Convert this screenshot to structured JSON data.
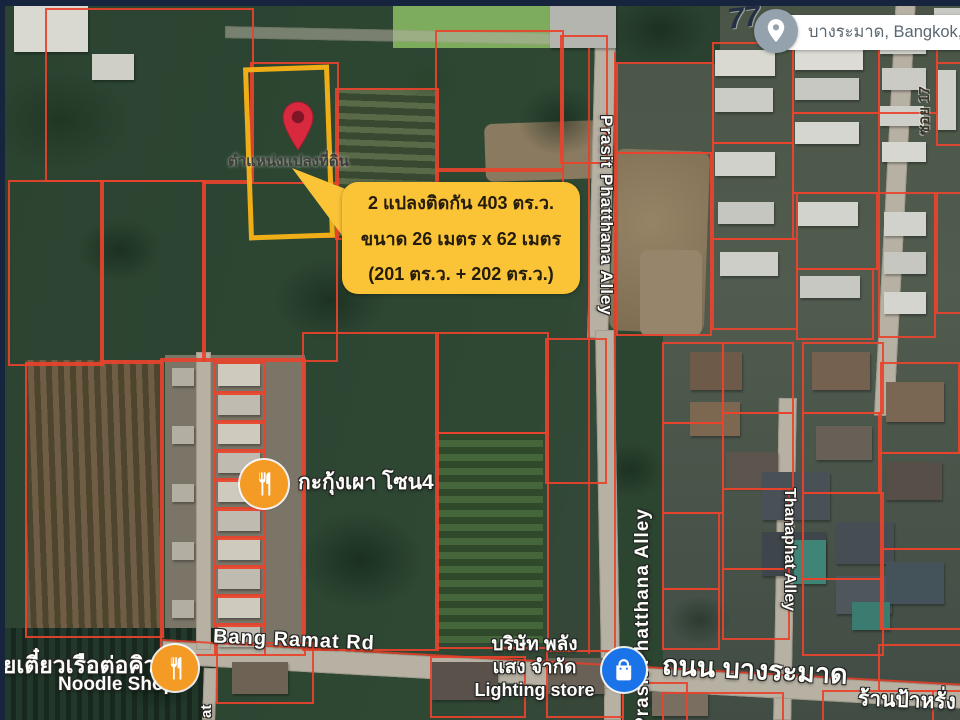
{
  "chrome": {
    "handwritten_note": "77",
    "search_pill": {
      "text": "บางระมาด, Bangkok, Tha",
      "icon": "map-pin-avatar"
    }
  },
  "annotation": {
    "plot_outline_color": "#efae17",
    "pin_color": "#d9293e",
    "marker_caption": "ตำแหน่งแปลงที่ดิน",
    "callout": {
      "bg": "#fbc437",
      "text_color": "#241c0c",
      "lines": [
        "2 แปลงติดกัน 403 ตร.ว.",
        "ขนาด 26 เมตร x 62 เมตร",
        "(201 ตร.ว. + 202 ตร.ว.)"
      ]
    }
  },
  "roads": {
    "prasit_upper": "Prasit Phatthana Alley",
    "prasit_lower": "Prasit Phatthana Alley",
    "thanaphat": "Thanaphat Alley",
    "soi17": "ซอย 17",
    "bang_ramat_en": "Bang Ramat Rd",
    "bang_ramat_th": "ถนน บางระมาด",
    "partial_left": "at"
  },
  "places": {
    "noodle_shop_th": "วยเตี๋ยวเรือต่อคิว",
    "noodle_shop_en": "Noodle Shop",
    "grill_zone": "กะกุ้งเผา โซน4",
    "lighting_co_line1": "บริษัท พลัง",
    "lighting_co_line2": "แสง จำกัด",
    "lighting_co_line3": "Lighting store",
    "shop_bottom_right": "ร้านป้าหรั่ง"
  },
  "map_colors": {
    "parcel_outline": "#e8432c",
    "vegetation": "#2d4532",
    "road": "#b7b1a3",
    "navy_border": "#16253d"
  },
  "icons": {
    "restaurant": "fork-and-knife",
    "store": "shopping-bag",
    "pin": "map-pin"
  }
}
